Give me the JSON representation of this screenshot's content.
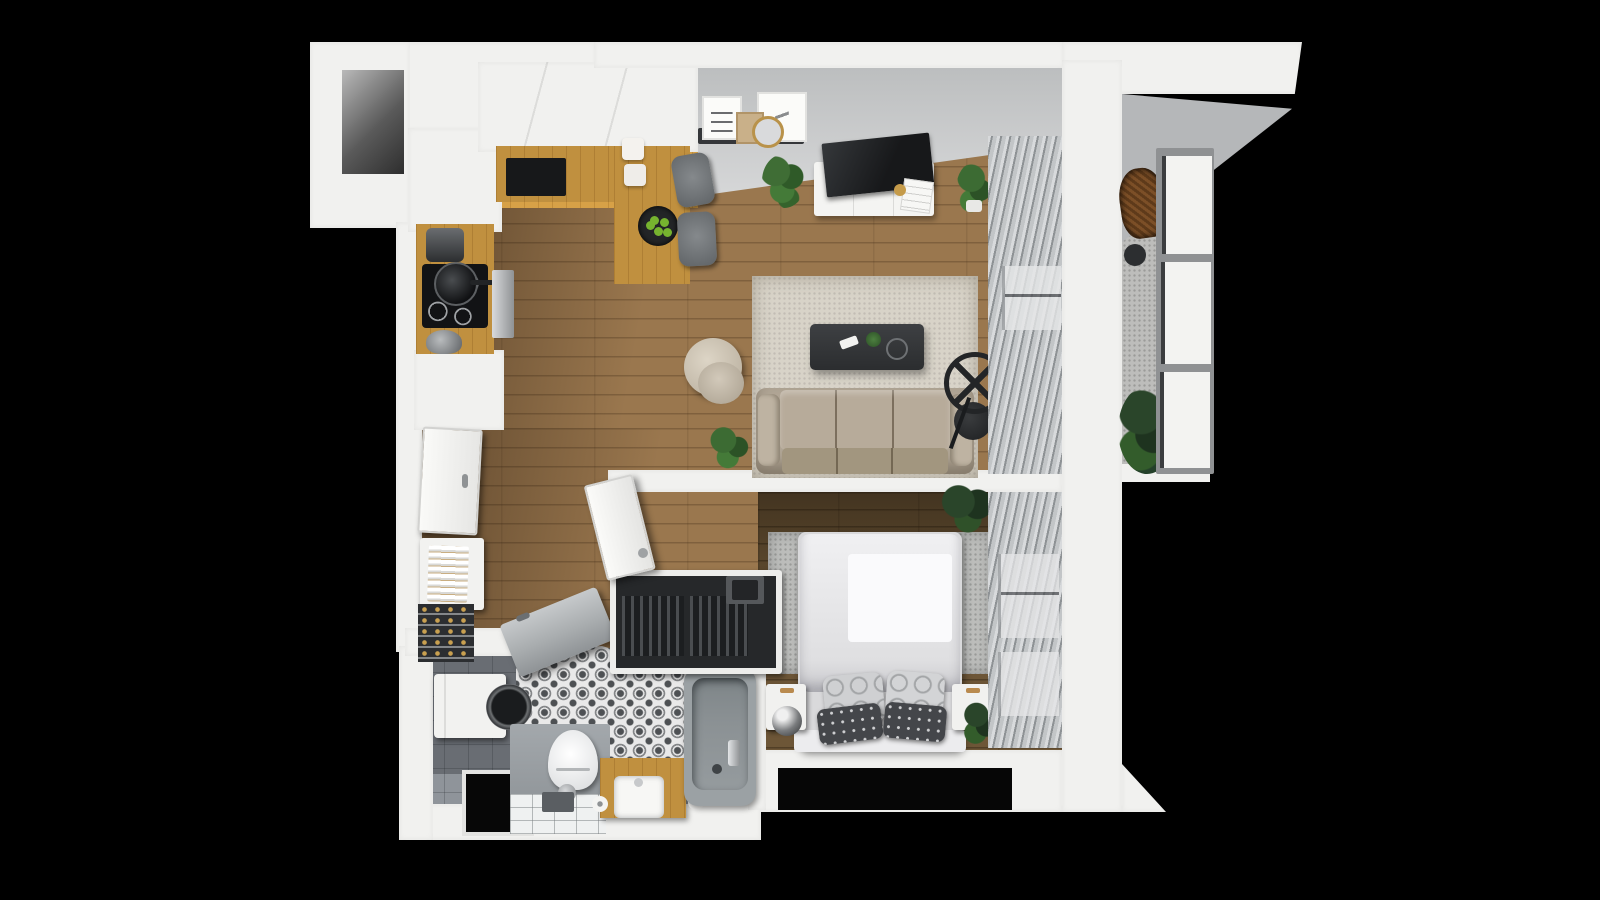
{
  "scene": {
    "kind": "3d-apartment-floor-plan-render",
    "view": "top-down cutaway",
    "background": "black"
  },
  "theme": {
    "background": "#000000",
    "wall": "#f1f1ef",
    "ceiling": "#c5c7c8",
    "wood_floor": "#9a774e",
    "wood_floor_dark": "#6d5637",
    "counter_wood": "#c0903f",
    "tile": "#8f949a",
    "tile_dark": "#6d7175",
    "pattern_tile_bg": "#e9e9e9",
    "pattern_tile_fg": "#4e5154",
    "rug_living": "#cbc4b6",
    "rug_bedroom": "#bcbdbb",
    "sofa": "#b0a595",
    "blind_light": "#d8dadc",
    "blind_dark": "#8e9295",
    "balcony_floor": "#bdbdbb",
    "glass": "#f3f3f1",
    "frame_dark": "#3b3d3f",
    "plant_green": "#3f6d35",
    "plant_dark": "#2a452a",
    "apple_green": "#76b32f",
    "bathtub": "#9ba1a4",
    "bed_linen": "#ececee",
    "pillow_dark": "#44464a",
    "chrome": "#c7c9cb"
  },
  "rooms": {
    "living_room": {
      "label": "Living room with sofa, armchair, rug, coffee table, TV stand, picture ledge and vertical blinds"
    },
    "kitchen": {
      "label": "Kitchen with L-shaped counter, induction cooktop, oven, dining table with fruit bowl and two chairs"
    },
    "bedroom": {
      "label": "Bedroom with double bed, patterned pillows, nightstands, sphere lamp, rug and vertical blinds"
    },
    "bathroom": {
      "label": "Bathroom with washing machine, toilet, wooden vanity with sink, bathtub and patterned tiles"
    },
    "hallway": {
      "label": "Hallway with entry door, sideboard, wine rack, shoe cabinet and open wardrobe with hanging clothes"
    },
    "balcony": {
      "label": "Balcony with rattan chair, plant and glazed window wall"
    }
  }
}
